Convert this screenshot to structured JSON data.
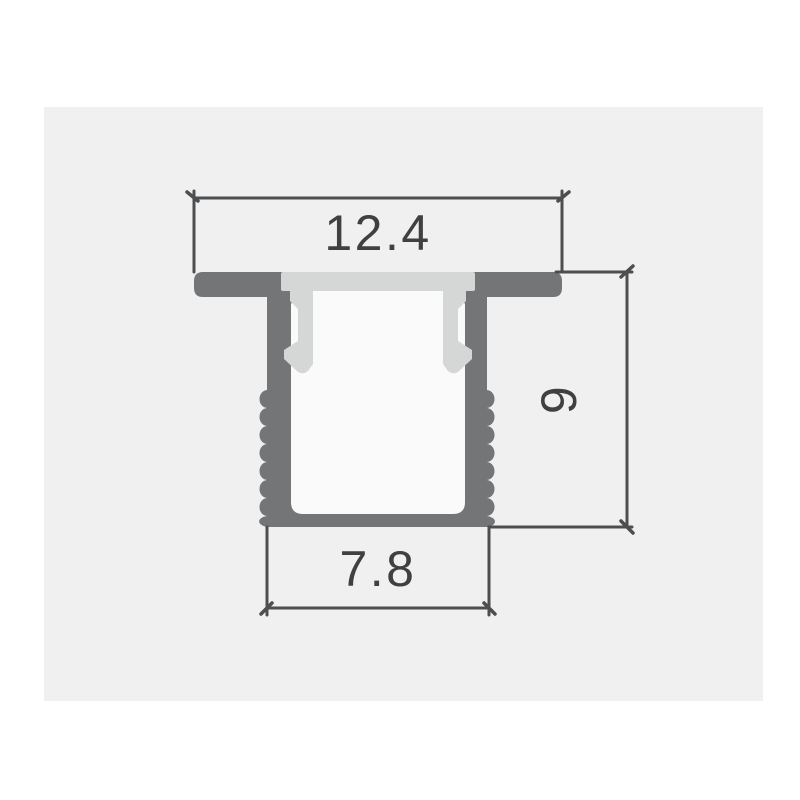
{
  "page": {
    "background": "#ffffff",
    "panel_background": "#f0f0f1"
  },
  "drawing": {
    "type": "cross-section technical drawing",
    "subject": "recessed LED aluminum profile channel with clip-in diffuser cover",
    "colors": {
      "aluminum": "#737577",
      "diffuser": "#d5d6d6",
      "cavity": "#fafafa",
      "dimension_line": "#4c4e50",
      "label_text": "#3e4042"
    },
    "dimensions": [
      {
        "id": "top-width",
        "label": "12.4",
        "orientation": "horizontal",
        "position": "top"
      },
      {
        "id": "overall-height",
        "label": "9",
        "orientation": "vertical",
        "position": "right"
      },
      {
        "id": "bottom-width",
        "label": "7.8",
        "orientation": "horizontal",
        "position": "bottom"
      }
    ]
  }
}
